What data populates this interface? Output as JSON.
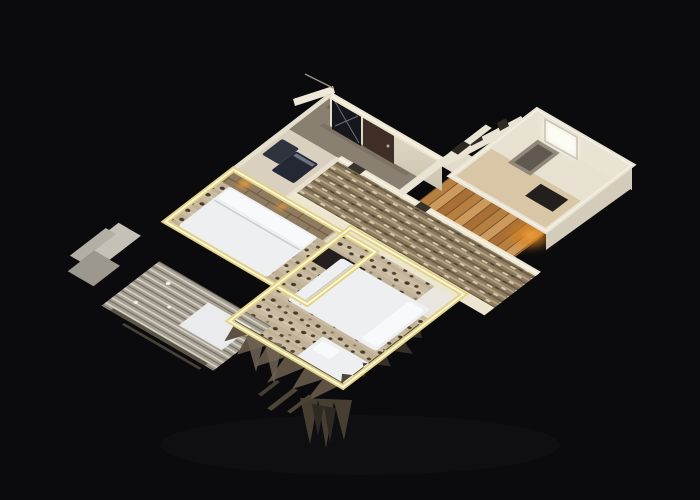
{
  "scene": {
    "kind": "3d-dollhouse-apartment-scan",
    "background": "#0b0b0e",
    "colors": {
      "background": "#0b0b0e",
      "wall_cream": "#ece5d1",
      "wall_face": "#e4ddca",
      "wall_face_shadow": "#d3ccba",
      "cut_outline_yellow": "#e3d280",
      "cut_outline_bright": "#fbf7e6",
      "bed_white": "#edeff1",
      "pillow_white": "#f7f9fb",
      "carpet_base": "#c9bba1",
      "carpet_spot": "#473a2b",
      "corridor_carpet": "#8d7c60",
      "wood_floor": "#c28b50",
      "entry_floor": "#8a8072",
      "bath_floor": "#d9d0bf",
      "kitchen_wall": "#e7e1d2",
      "door_brown": "#3f2e25",
      "glass_dark": "#15171c",
      "fixture_dark": "#232834",
      "fixture_dark2": "#2e333e",
      "radiator_dark": "#16130e",
      "amber_light": "#e89b3a",
      "amber_glow": "#d98324",
      "window_glow": "#fcfcf5",
      "rug_gray": "#a8a295",
      "blanket_white": "#e9ebec",
      "fringe_brown": "#5d5243",
      "fringe_dark": "#39332a",
      "dresser_dark": "#221f1c"
    },
    "rooms": [
      {
        "id": "entry-hall"
      },
      {
        "id": "bathroom"
      },
      {
        "id": "corridor"
      },
      {
        "id": "wood-hallway"
      },
      {
        "id": "kitchen"
      },
      {
        "id": "bedroom-left"
      },
      {
        "id": "bedroom-main"
      },
      {
        "id": "balcony-fragment"
      }
    ],
    "furniture": [
      "entrance-door",
      "glass-partition",
      "washing-machine",
      "toilet",
      "radiator",
      "window",
      "wall-mirror",
      "double-bed-left",
      "double-bed-main",
      "single-bed",
      "tv-cabinet",
      "bench",
      "headboard-shelf",
      "nightstand",
      "wall-lamp",
      "area-rug",
      "folded-blanket"
    ]
  }
}
